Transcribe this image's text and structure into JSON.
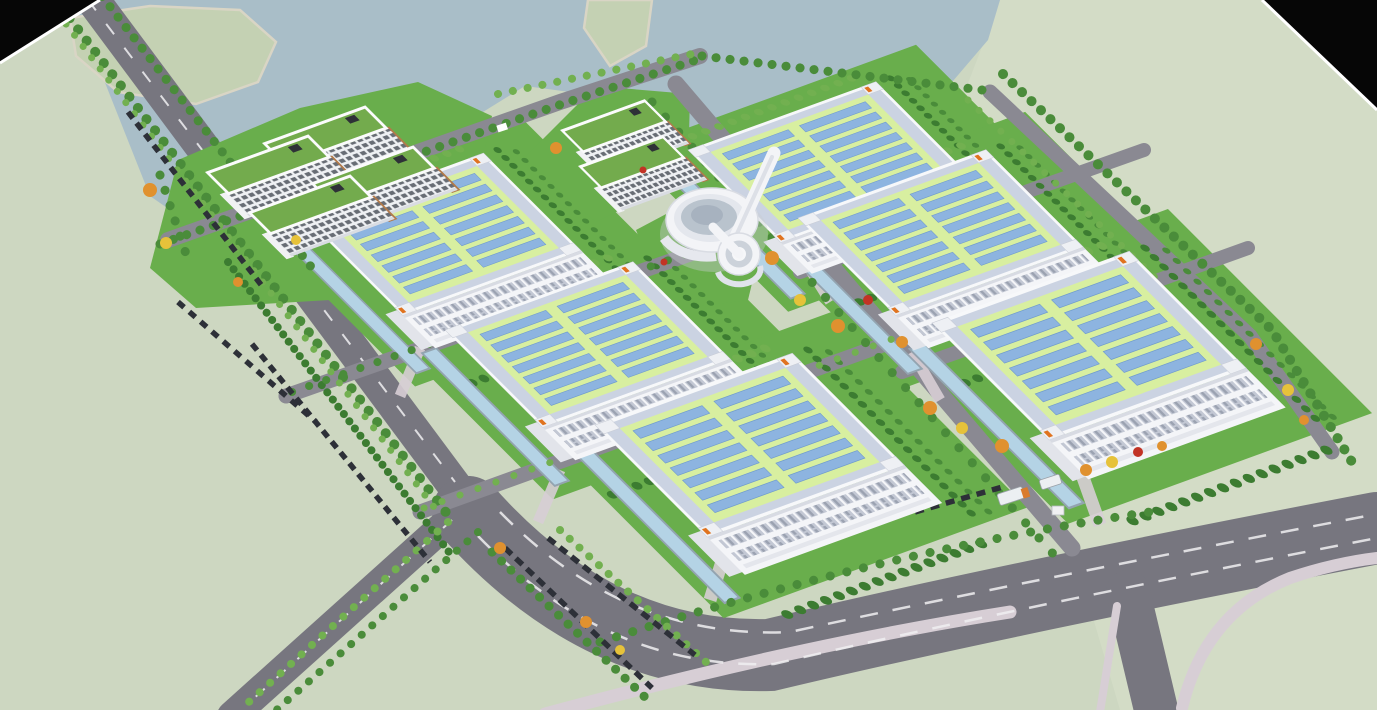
{
  "scene": {
    "description": "Aerial 3D architectural rendering of an industrial park campus with solar-roof factory halls, dormitory blocks, a circular research center, tree-lined roads and a lake",
    "inventory": {
      "factory_halls": 6,
      "dormitory_office_blocks": 6,
      "circular_center_building": 1,
      "solar_panel_groups_per_roof": 2,
      "solar_rows_per_group": 7,
      "lakes": 1,
      "reflecting_channels": 6
    }
  },
  "palette": {
    "ground": "#cdd7c1",
    "groundLight": "#d6dfca",
    "water": "#a9bec8",
    "island": "#c4d1b3",
    "shore": "#d9d5c5",
    "roadMain": "#77767f",
    "roadInner": "#8a8992",
    "roadDark": "#6e6d76",
    "dash": "#f0f0f2",
    "sidewalk": "#d7ced5",
    "lawn": "#69ae4c",
    "hedge": "#3c7c31",
    "treeDark": "#4a8c3a",
    "treeLight": "#72b050",
    "autumnOrange": "#e0912f",
    "autumnYellow": "#e6c23a",
    "autumnRed": "#c23325",
    "factoryWallFront": "#f4f5f8",
    "factoryWallSide": "#e2e4ea",
    "factoryParapet": "#f7f8fa",
    "roofDeck": "#cbd3e2",
    "roofField": "#d8efa0",
    "solarPanel": "#8db4e0",
    "solarEdge": "#6f9bcd",
    "windowBand": "#c3c8d4",
    "officeRoof": "#73ab4d",
    "officeWindow": "#686d75",
    "officeTrim": "#b27a4a",
    "channel": "#b4d3e5",
    "channelRim": "#93a4b0",
    "car": "#2d3038",
    "truck": "#eceff2",
    "truckOrange": "#d97b2e",
    "accentOrange": "#e0731f",
    "cornerBlack": "#060606",
    "cornerEdge": "#ffffff",
    "centerWhite": "#f3f4f7",
    "centerGlass": "#b9c3cd"
  }
}
